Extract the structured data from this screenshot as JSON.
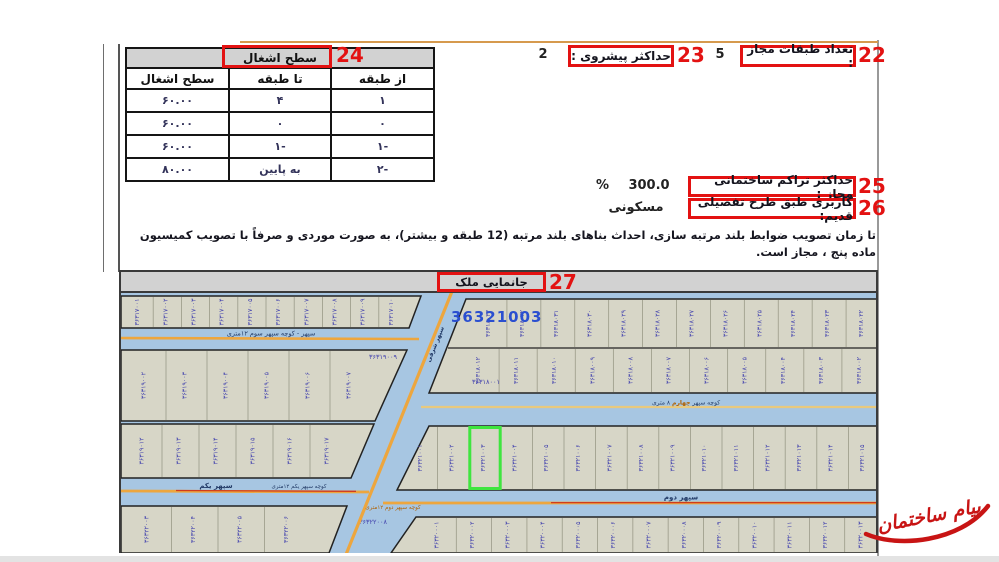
{
  "annotations": {
    "n22": "22",
    "n23": "23",
    "n24": "24",
    "n25": "25",
    "n26": "26",
    "n27": "27"
  },
  "fields": {
    "floors_allowed": {
      "label": "تعداد طبقات مجاز :",
      "value": "5"
    },
    "max_projection": {
      "label": "حداکثر پیشروی :",
      "value": "2"
    },
    "max_density": {
      "label": "حداکثر تراکم ساختمانی مجاز :",
      "value": "300.0",
      "unit": "%"
    },
    "old_plan_usage": {
      "label": "کاربری طبق طرح تفصیلی قدیم:",
      "value": "مسکونی"
    }
  },
  "occupancy_table": {
    "title": "سطح اشغال",
    "columns": [
      "از طبقه",
      "تا طبقه",
      "سطح اشغال"
    ],
    "rows": [
      [
        "۱",
        "۴",
        "۶۰.۰۰"
      ],
      [
        "۰",
        "۰",
        "۶۰.۰۰"
      ],
      [
        "۱-",
        "۱-",
        "۶۰.۰۰"
      ],
      [
        "۲-",
        "به پایین",
        "۸۰.۰۰"
      ]
    ]
  },
  "note": "تا زمان تصویب ضوابط بلند مرتبه سازی، احداث بناهای بلند مرتبه (12 طبقه و بیشتر)، به صورت موردی و صرفاً با تصویب کمیسیون ماده پنج ، مجاز است.",
  "map": {
    "title": "جانمایی ملک",
    "highlight_parcel_label": "36321003",
    "highlight": {
      "row": "mid",
      "index": 2
    },
    "streets": {
      "sevvom": {
        "name": "سپهر - کوچه سپهر سوم ۱۲متری"
      },
      "sharghi": {
        "name": "سپهر شرقی"
      },
      "chaharom": {
        "parts": [
          "کوچه سپهر ",
          "چهارم",
          " ۸ متری"
        ]
      },
      "yekom": {
        "name": "سپهر یکم",
        "name2": "کوچه سپهر یکم ۱۲متری"
      },
      "dovom": {
        "name": "سپهر دوم",
        "name2": "کوچه سپهر دوم ۱۲متری"
      }
    },
    "corner_labels": [
      "۳۶۳۱۹۰۰۹",
      "۳۶۳۱۸۰۰۱",
      "۳۶۳۲۲۰۰۸"
    ],
    "parcels": {
      "top_strip": [
        "۳۶۳۱۷۰۰۱",
        "۳۶۳۱۷۰۰۲",
        "۳۶۳۱۷۰۰۳",
        "۳۶۳۱۷۰۰۴",
        "۳۶۳۱۷۰۰۵",
        "۳۶۳۱۷۰۰۶",
        "۳۶۳۱۷۰۰۷",
        "۳۶۳۱۷۰۰۸",
        "۳۶۳۱۷۰۰۹",
        "۳۶۳۱۷۰۱۰"
      ],
      "left_a": [
        "۳۶۳۱۹۰۰۲",
        "۳۶۳۱۹۰۰۳",
        "۳۶۳۱۹۰۰۴",
        "۳۶۳۱۹۰۰۵",
        "۳۶۳۱۹۰۰۶",
        "۳۶۳۱۹۰۰۷"
      ],
      "left_b": [
        "۳۶۳۱۹۰۱۲",
        "۳۶۳۱۹۰۱۳",
        "۳۶۳۱۹۰۱۴",
        "۳۶۳۱۹۰۱۵",
        "۳۶۳۱۹۰۱۶",
        "۳۶۳۱۹۰۱۷"
      ],
      "left_c": [
        "۳۶۳۲۲۰۰۳",
        "۳۶۳۲۲۰۰۴",
        "۳۶۳۲۲۰۰۵",
        "۳۶۳۲۲۰۰۶"
      ],
      "right_top": [
        "۳۶۳۱۸۰۳۳",
        "۳۶۳۱۸۰۳۲",
        "۳۶۳۱۸۰۳۱",
        "۳۶۳۱۸۰۳۰",
        "۳۶۳۱۸۰۲۹",
        "۳۶۳۱۸۰۲۸",
        "۳۶۳۱۸۰۲۷",
        "۳۶۳۱۸۰۲۶",
        "۳۶۳۱۸۰۲۵",
        "۳۶۳۱۸۰۲۴",
        "۳۶۳۱۸۰۲۳",
        "۳۶۳۱۸۰۲۲"
      ],
      "right_bottom": [
        "۳۶۳۱۸۰۱۲",
        "۳۶۳۱۸۰۱۱",
        "۳۶۳۱۸۰۱۰",
        "۳۶۳۱۸۰۰۹",
        "۳۶۳۱۸۰۰۸",
        "۳۶۳۱۸۰۰۷",
        "۳۶۳۱۸۰۰۶",
        "۳۶۳۱۸۰۰۵",
        "۳۶۳۱۸۰۰۴",
        "۳۶۳۱۸۰۰۳",
        "۳۶۳۱۸۰۰۲"
      ],
      "mid": [
        "۳۶۳۲۱۰۰۱",
        "۳۶۳۲۱۰۰۲",
        "۳۶۳۲۱۰۰۳",
        "۳۶۳۲۱۰۰۴",
        "۳۶۳۲۱۰۰۵",
        "۳۶۳۲۱۰۰۶",
        "۳۶۳۲۱۰۰۷",
        "۳۶۳۲۱۰۰۸",
        "۳۶۳۲۱۰۰۹",
        "۳۶۳۲۱۰۱۰",
        "۳۶۳۲۱۰۱۱",
        "۳۶۳۲۱۰۱۲",
        "۳۶۳۲۱۰۱۳",
        "۳۶۳۲۱۰۱۴",
        "۳۶۳۲۱۰۱۵"
      ],
      "bottom": [
        "۳۶۳۲۰۰۰۱",
        "۳۶۳۲۰۰۰۲",
        "۳۶۳۲۰۰۰۳",
        "۳۶۳۲۰۰۰۴",
        "۳۶۳۲۰۰۰۵",
        "۳۶۳۲۰۰۰۶",
        "۳۶۳۲۰۰۰۷",
        "۳۶۳۲۰۰۰۸",
        "۳۶۳۲۰۰۰۹",
        "۳۶۳۲۰۰۱۰",
        "۳۶۳۲۰۰۱۱",
        "۳۶۳۲۰۰۱۲",
        "۳۶۳۲۰۰۱۳"
      ]
    },
    "colors": {
      "water_bg": "#a7c6e2",
      "parcel_fill": "#d7d6c7",
      "parcel_edge": "#222222",
      "divider": "#9a9a88",
      "number": "#4343ae",
      "big_label": "#2b4fd0",
      "street_line": "#eda63e",
      "street_red": "#d03a1e",
      "street_text": "#223a66",
      "street_orange_text": "#b06000",
      "highlight_green": "#3fe53f"
    }
  },
  "watermark": {
    "text": "پیام ساختمان",
    "color": "#c81414"
  },
  "accents": {
    "annotation_red": "#e31212",
    "top_rule": "#d69a4e"
  }
}
